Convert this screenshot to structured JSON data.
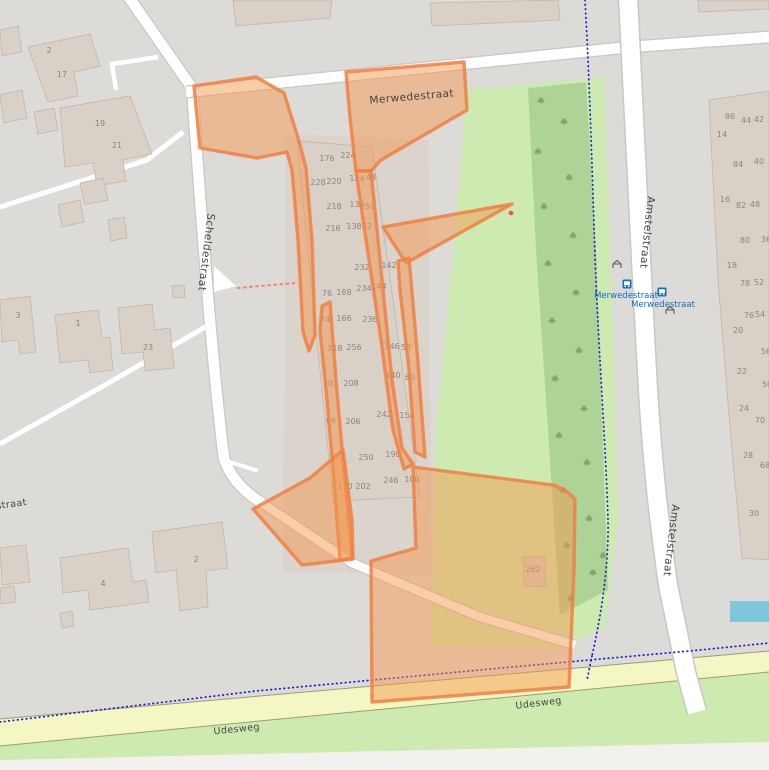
{
  "map": {
    "street_labels": [
      {
        "text": "Merwedestraat",
        "x": 412,
        "y": 100,
        "rotate": -5,
        "cls": "street"
      },
      {
        "text": "Scheldestraat",
        "x": 203,
        "y": 252,
        "rotate": 97,
        "cls": "street"
      },
      {
        "text": "Amstelstraat",
        "x": 644,
        "y": 232,
        "rotate": 96,
        "cls": "street"
      },
      {
        "text": "Amstelstraat",
        "x": 668,
        "y": 540,
        "rotate": 97,
        "cls": "street"
      },
      {
        "text": "Udesweg",
        "x": 237,
        "y": 732,
        "rotate": -6,
        "cls": "street small"
      },
      {
        "text": "Udesweg",
        "x": 539,
        "y": 706,
        "rotate": -7,
        "cls": "street small"
      },
      {
        "text": "straat",
        "x": 12,
        "y": 507,
        "rotate": -8,
        "cls": "street small"
      }
    ],
    "transit_stops": [
      {
        "label": "Merwedestraat",
        "label_x": 626,
        "label_y": 298,
        "icon_x": 627,
        "icon_y": 284
      },
      {
        "label": "Merwedestraat",
        "label_x": 663,
        "label_y": 307,
        "icon_x": 662,
        "icon_y": 292
      }
    ],
    "shelters": [
      {
        "x": 617,
        "y": 265
      },
      {
        "x": 670,
        "y": 311
      }
    ],
    "house_numbers": [
      [
        49,
        53,
        "2"
      ],
      [
        62,
        77,
        "17"
      ],
      [
        100,
        126,
        "19"
      ],
      [
        117,
        148,
        "21"
      ],
      [
        18,
        318,
        "3"
      ],
      [
        78,
        326,
        "1"
      ],
      [
        148,
        350,
        "23"
      ],
      [
        103,
        586,
        "4"
      ],
      [
        196,
        562,
        "2"
      ],
      [
        327,
        161,
        "176"
      ],
      [
        348,
        158,
        "224"
      ],
      [
        318,
        185,
        "228"
      ],
      [
        334,
        184,
        "220"
      ],
      [
        357,
        181,
        "134"
      ],
      [
        371,
        180,
        "48"
      ],
      [
        334,
        209,
        "218"
      ],
      [
        357,
        207,
        "136"
      ],
      [
        370,
        209,
        "50"
      ],
      [
        333,
        231,
        "216"
      ],
      [
        354,
        229,
        "138"
      ],
      [
        367,
        229,
        "52"
      ],
      [
        362,
        270,
        "232"
      ],
      [
        389,
        268,
        "142"
      ],
      [
        364,
        291,
        "234"
      ],
      [
        379,
        289,
        "144"
      ],
      [
        327,
        296,
        "76"
      ],
      [
        344,
        295,
        "168"
      ],
      [
        325,
        322,
        "74"
      ],
      [
        344,
        321,
        "166"
      ],
      [
        370,
        322,
        "236"
      ],
      [
        335,
        351,
        "118"
      ],
      [
        354,
        350,
        "256"
      ],
      [
        392,
        349,
        "146"
      ],
      [
        406,
        350,
        "58"
      ],
      [
        328,
        386,
        "70"
      ],
      [
        351,
        386,
        "208"
      ],
      [
        393,
        378,
        "140"
      ],
      [
        410,
        380,
        "60"
      ],
      [
        331,
        423,
        "66"
      ],
      [
        353,
        424,
        "206"
      ],
      [
        384,
        417,
        "242"
      ],
      [
        407,
        418,
        "154"
      ],
      [
        366,
        460,
        "250"
      ],
      [
        393,
        457,
        "198"
      ],
      [
        345,
        489,
        "110"
      ],
      [
        363,
        489,
        "202"
      ],
      [
        391,
        483,
        "246"
      ],
      [
        412,
        482,
        "100"
      ],
      [
        533,
        572,
        "262"
      ],
      [
        730,
        119,
        "86"
      ],
      [
        746,
        123,
        "44"
      ],
      [
        759,
        122,
        "42"
      ],
      [
        722,
        137,
        "14"
      ],
      [
        738,
        167,
        "84"
      ],
      [
        759,
        164,
        "40"
      ],
      [
        725,
        202,
        "16"
      ],
      [
        741,
        208,
        "82"
      ],
      [
        755,
        207,
        "48"
      ],
      [
        745,
        243,
        "80"
      ],
      [
        766,
        242,
        "36"
      ],
      [
        732,
        268,
        "18"
      ],
      [
        745,
        286,
        "78"
      ],
      [
        759,
        285,
        "52"
      ],
      [
        749,
        318,
        "76"
      ],
      [
        760,
        317,
        "54"
      ],
      [
        738,
        333,
        "20"
      ],
      [
        766,
        354,
        "56"
      ],
      [
        742,
        374,
        "22"
      ],
      [
        767,
        387,
        "50"
      ],
      [
        744,
        411,
        "24"
      ],
      [
        760,
        423,
        "70"
      ],
      [
        748,
        458,
        "28"
      ],
      [
        765,
        468,
        "68"
      ],
      [
        754,
        516,
        "30"
      ]
    ],
    "trees": [
      [
        541,
        101
      ],
      [
        564,
        122
      ],
      [
        538,
        152
      ],
      [
        569,
        178
      ],
      [
        544,
        207
      ],
      [
        573,
        236
      ],
      [
        548,
        264
      ],
      [
        576,
        293
      ],
      [
        552,
        321
      ],
      [
        579,
        351
      ],
      [
        555,
        379
      ],
      [
        584,
        409
      ],
      [
        559,
        436
      ],
      [
        587,
        463
      ],
      [
        563,
        491
      ],
      [
        589,
        519
      ],
      [
        567,
        546
      ],
      [
        593,
        573
      ],
      [
        571,
        599
      ],
      [
        603,
        556
      ]
    ],
    "colors": {
      "background": "#dcdbd8",
      "park": "#cdebb0",
      "woodland": "#a8cf93",
      "building": "#d9d0c8",
      "road_yellow": "#f4f7c3",
      "highlight_fill": "#f5974b",
      "highlight_stroke": "#ee8044",
      "cycleway_blue": "#2525c9",
      "footway_red": "#f98072",
      "transit_blue": "#0d6fbf",
      "water": "#7fc7da"
    }
  }
}
